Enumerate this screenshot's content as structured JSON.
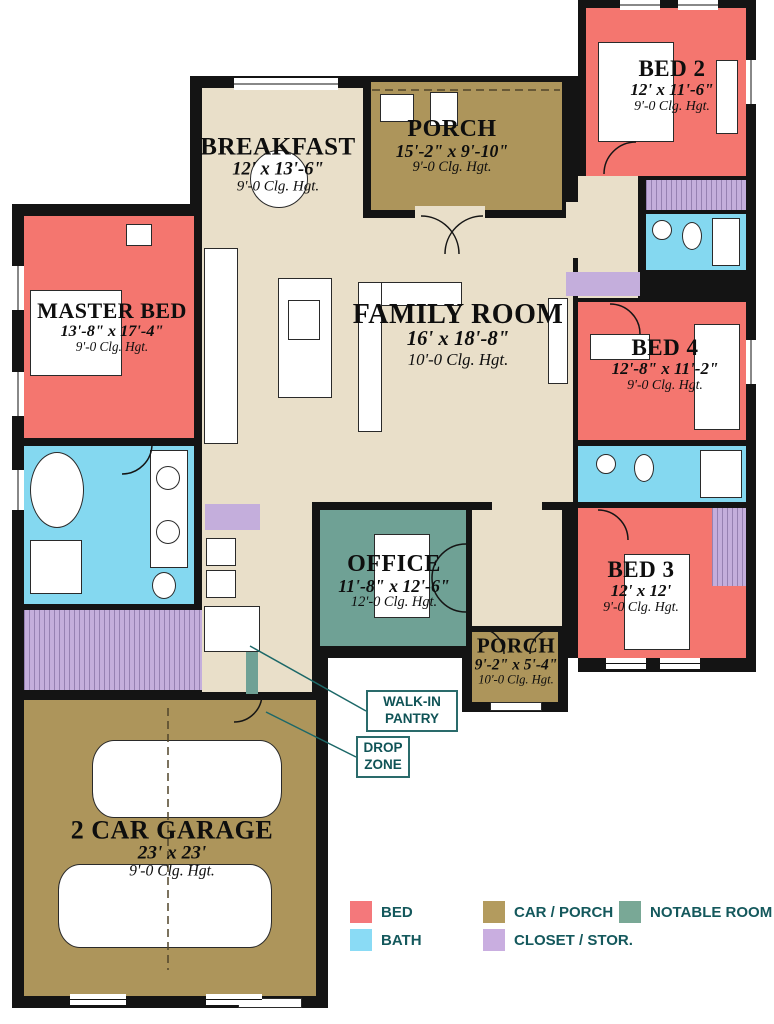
{
  "plan": {
    "rooms": [
      {
        "key": "master_bed",
        "name": "MASTER BED",
        "dims": "13'-8\" x 17'-4\"",
        "ceiling": "9'-0 Clg. Hgt.",
        "color_class": "bed"
      },
      {
        "key": "breakfast",
        "name": "BREAKFAST",
        "dims": "12' x 13'-6\"",
        "ceiling": "9'-0 Clg. Hgt.",
        "color_class": "floor"
      },
      {
        "key": "porch_top",
        "name": "PORCH",
        "dims": "15'-2\" x 9'-10\"",
        "ceiling": "9'-0 Clg. Hgt.",
        "color_class": "car_porch"
      },
      {
        "key": "bed2",
        "name": "BED 2",
        "dims": "12' x 11'-6\"",
        "ceiling": "9'-0 Clg. Hgt.",
        "color_class": "bed"
      },
      {
        "key": "family_room",
        "name": "FAMILY ROOM",
        "dims": "16' x 18'-8\"",
        "ceiling": "10'-0 Clg. Hgt.",
        "color_class": "floor"
      },
      {
        "key": "bed4",
        "name": "BED 4",
        "dims": "12'-8\" x 11'-2\"",
        "ceiling": "9'-0 Clg. Hgt.",
        "color_class": "bed"
      },
      {
        "key": "office",
        "name": "OFFICE",
        "dims": "11'-8\" x 12'-6\"",
        "ceiling": "12'-0 Clg. Hgt.",
        "color_class": "notable"
      },
      {
        "key": "bed3",
        "name": "BED 3",
        "dims": "12' x 12'",
        "ceiling": "9'-0 Clg. Hgt.",
        "color_class": "bed"
      },
      {
        "key": "porch_bottom",
        "name": "PORCH",
        "dims": "9'-2\" x 5'-4\"",
        "ceiling": "10'-0 Clg. Hgt.",
        "color_class": "car_porch"
      },
      {
        "key": "garage",
        "name": "2 CAR GARAGE",
        "dims": "23' x 23'",
        "ceiling": "9'-0 Clg. Hgt.",
        "color_class": "car_porch"
      }
    ],
    "annotations": {
      "walk_in_pantry": [
        "WALK-IN",
        "PANTRY"
      ],
      "drop_zone": [
        "DROP",
        "ZONE"
      ]
    }
  },
  "legend": {
    "items": [
      {
        "label": "BED",
        "color": "#F4787B"
      },
      {
        "label": "BATH",
        "color": "#8ADBF5"
      },
      {
        "label": "CAR / PORCH",
        "color": "#B39B5E"
      },
      {
        "label": "CLOSET / STOR.",
        "color": "#C9AEE0"
      },
      {
        "label": "NOTABLE ROOM",
        "color": "#79A896"
      }
    ]
  },
  "palette": {
    "bed": "#F4766F",
    "bath": "#84D8F0",
    "car_porch": "#AD955B",
    "closet_stor": "#C4AEDC",
    "notable_room": "#6FA195",
    "floor": "#E9DFC9",
    "wall": "#141414",
    "annotation_text": "#0F5356",
    "annotation_border": "#2A6B6B",
    "leader_line": "#1C6868"
  }
}
